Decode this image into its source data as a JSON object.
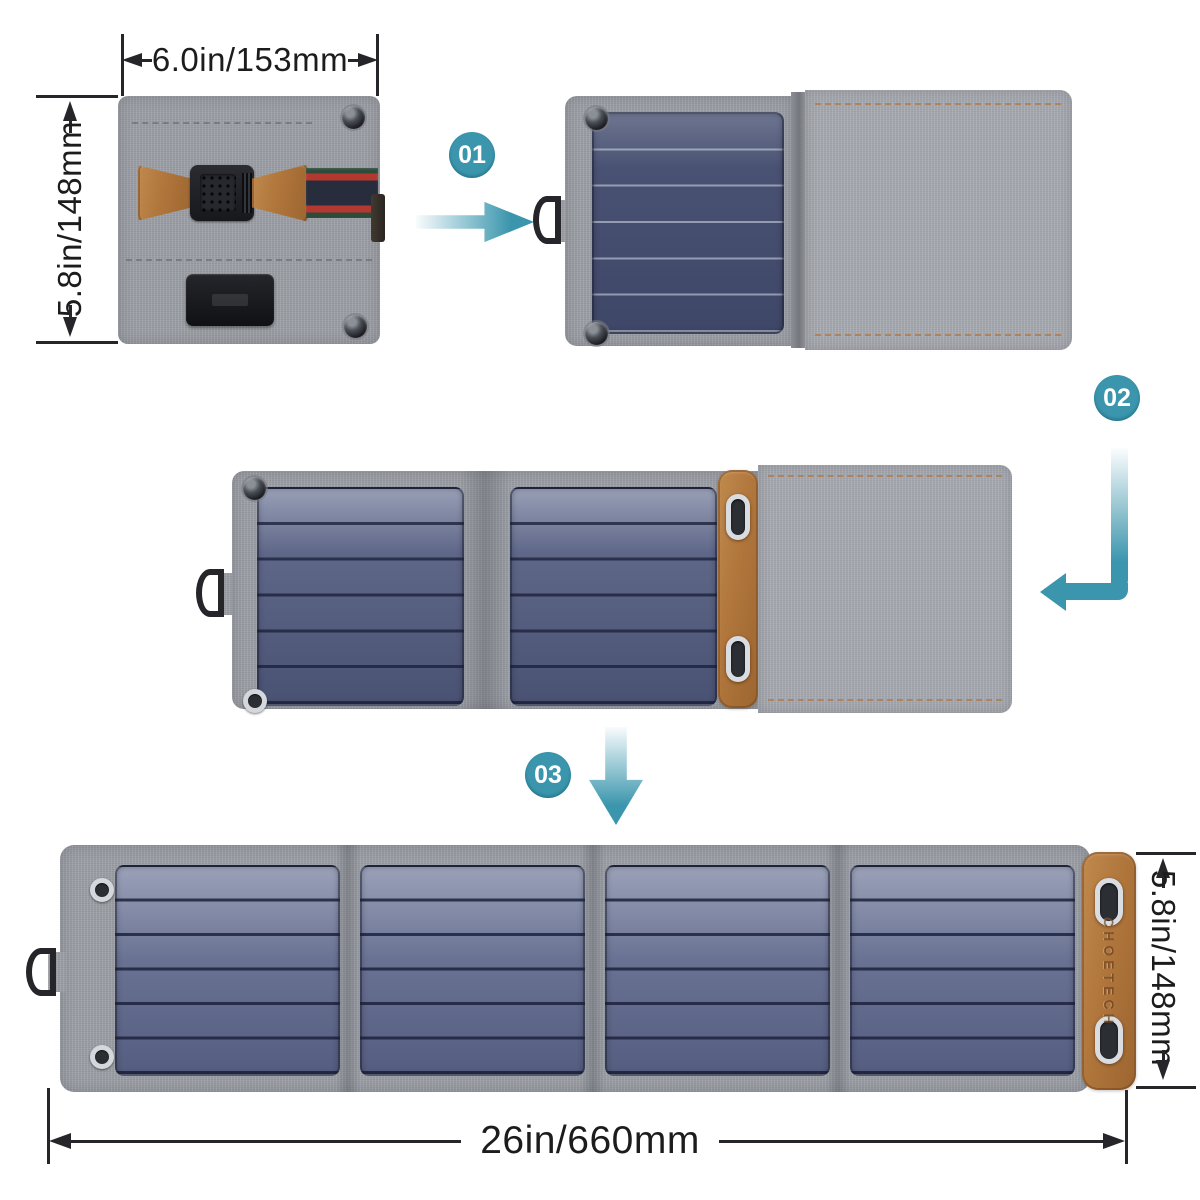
{
  "annotations": {
    "dim_top": {
      "label": "6.0in/153mm"
    },
    "dim_left": {
      "label": "5.8in/148mm"
    },
    "dim_right": {
      "label": "5.8in/148mm"
    },
    "dim_bottom": {
      "label": "26in/660mm"
    }
  },
  "steps": [
    {
      "label": "01"
    },
    {
      "label": "02"
    },
    {
      "label": "03"
    }
  ],
  "product": {
    "brand_embossed": "CHOETECH",
    "solar_cells_per_panel": 6,
    "panels_when_fully_open": 4
  },
  "icons": [
    "d-ring-icon",
    "snap-button-icon",
    "eyelet-icon",
    "oval-eyelet-icon",
    "buckle-icon",
    "arrow-right-icon",
    "arrow-elbow-icon",
    "arrow-down-icon",
    "dimension-arrowhead-icon"
  ],
  "colors": {
    "accent_teal": "#3b96ad",
    "fabric_gray": "#9b9ea4",
    "panel_navy": "#434b6d",
    "panel_slate": "#989fb6",
    "leather_tan": "#b0763c",
    "webbing_navy": "#272d3d",
    "webbing_red": "#b3382f",
    "webbing_green": "#2e4a39",
    "dimension_text": "#1c1c1c"
  }
}
